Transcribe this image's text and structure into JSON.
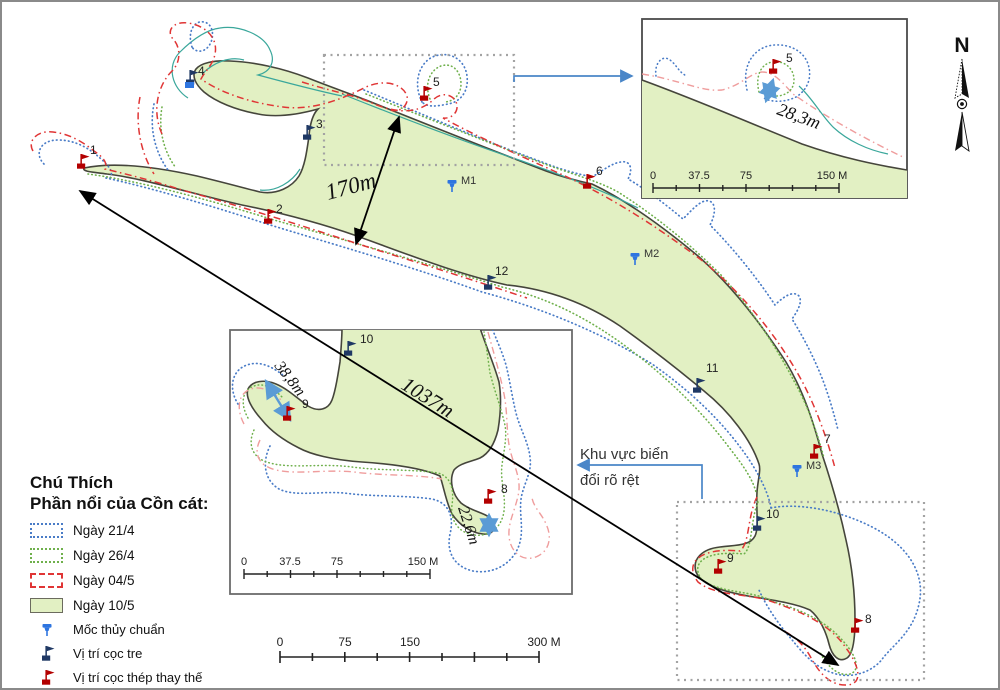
{
  "legend": {
    "title": "Chú Thích",
    "subtitle": "Phần nổi của Cồn cát:",
    "items": [
      {
        "label": "Ngày 21/4",
        "style": "dotted",
        "color": "#4a7cc7"
      },
      {
        "label": "Ngày 26/4",
        "style": "dotted",
        "color": "#6fb04c"
      },
      {
        "label": "Ngày 04/5",
        "style": "dash-dot",
        "color": "#e03535"
      },
      {
        "label": "Ngày 10/5",
        "style": "fill",
        "color": "#e2f0c3"
      }
    ],
    "markers": [
      {
        "label": "Mốc thủy chuẩn",
        "icon": "benchmark-pin",
        "color": "#2e75e0"
      },
      {
        "label": "Vị trí cọc tre",
        "icon": "flag",
        "color": "#1f3864"
      },
      {
        "label": "Vị trí cọc thép thay thế",
        "icon": "flag",
        "color": "#b30000"
      }
    ]
  },
  "compass": {
    "label": "N"
  },
  "main_map": {
    "points": {
      "p1": {
        "label": "1",
        "marker": "steel-flag"
      },
      "p2": {
        "label": "2",
        "marker": "steel-flag"
      },
      "p3": {
        "label": "3",
        "marker": "bamboo-flag"
      },
      "p4": {
        "label": "4",
        "marker": "bamboo-flag"
      },
      "p5": {
        "label": "5",
        "marker": "steel-flag"
      },
      "p6": {
        "label": "6",
        "marker": "steel-flag"
      },
      "p7": {
        "label": "7",
        "marker": "steel-flag"
      },
      "p8": {
        "label": "8",
        "marker": "steel-flag"
      },
      "p9": {
        "label": "9",
        "marker": "steel-flag"
      },
      "p10": {
        "label": "10",
        "marker": "bamboo-flag"
      },
      "p11": {
        "label": "11",
        "marker": "bamboo-flag"
      },
      "p12": {
        "label": "12",
        "marker": "bamboo-flag"
      }
    },
    "benchmarks": {
      "m1": {
        "label": "M1"
      },
      "m2": {
        "label": "M2"
      },
      "m3": {
        "label": "M3"
      }
    },
    "measurements": {
      "d170": {
        "label": "170m"
      },
      "d1037": {
        "label": "1037m"
      }
    },
    "callout": {
      "line1": "Khu vực biển",
      "line2": "đổi rõ rệt"
    },
    "scalebar": {
      "labels": [
        "0",
        "75",
        "150",
        "300 M"
      ]
    }
  },
  "inset_top_right": {
    "measurement": {
      "label": "28,3m"
    },
    "scalebar": {
      "labels": [
        "0",
        "37.5",
        "75",
        "150 M"
      ]
    }
  },
  "inset_middle": {
    "measurements": {
      "d388": {
        "label": "38,8m"
      },
      "d226": {
        "label": "22,6m"
      }
    },
    "scalebar": {
      "labels": [
        "0",
        "37.5",
        "75",
        "150 M"
      ]
    }
  },
  "colors": {
    "sand_fill": "#e2f0c3",
    "sand_outline": "#45453b",
    "day_21_4": "#4a7cc7",
    "day_26_4": "#6fb04c",
    "day_04_5": "#e03535",
    "inset_pink": "#ef9d9d",
    "teal_line": "#3aa79b",
    "benchmark_blue": "#2e75e0",
    "bamboo_navy": "#1f3864",
    "steel_red": "#b30000",
    "connector_blue": "#4a86c8",
    "zoom_box_gray": "#a3a3a3"
  }
}
